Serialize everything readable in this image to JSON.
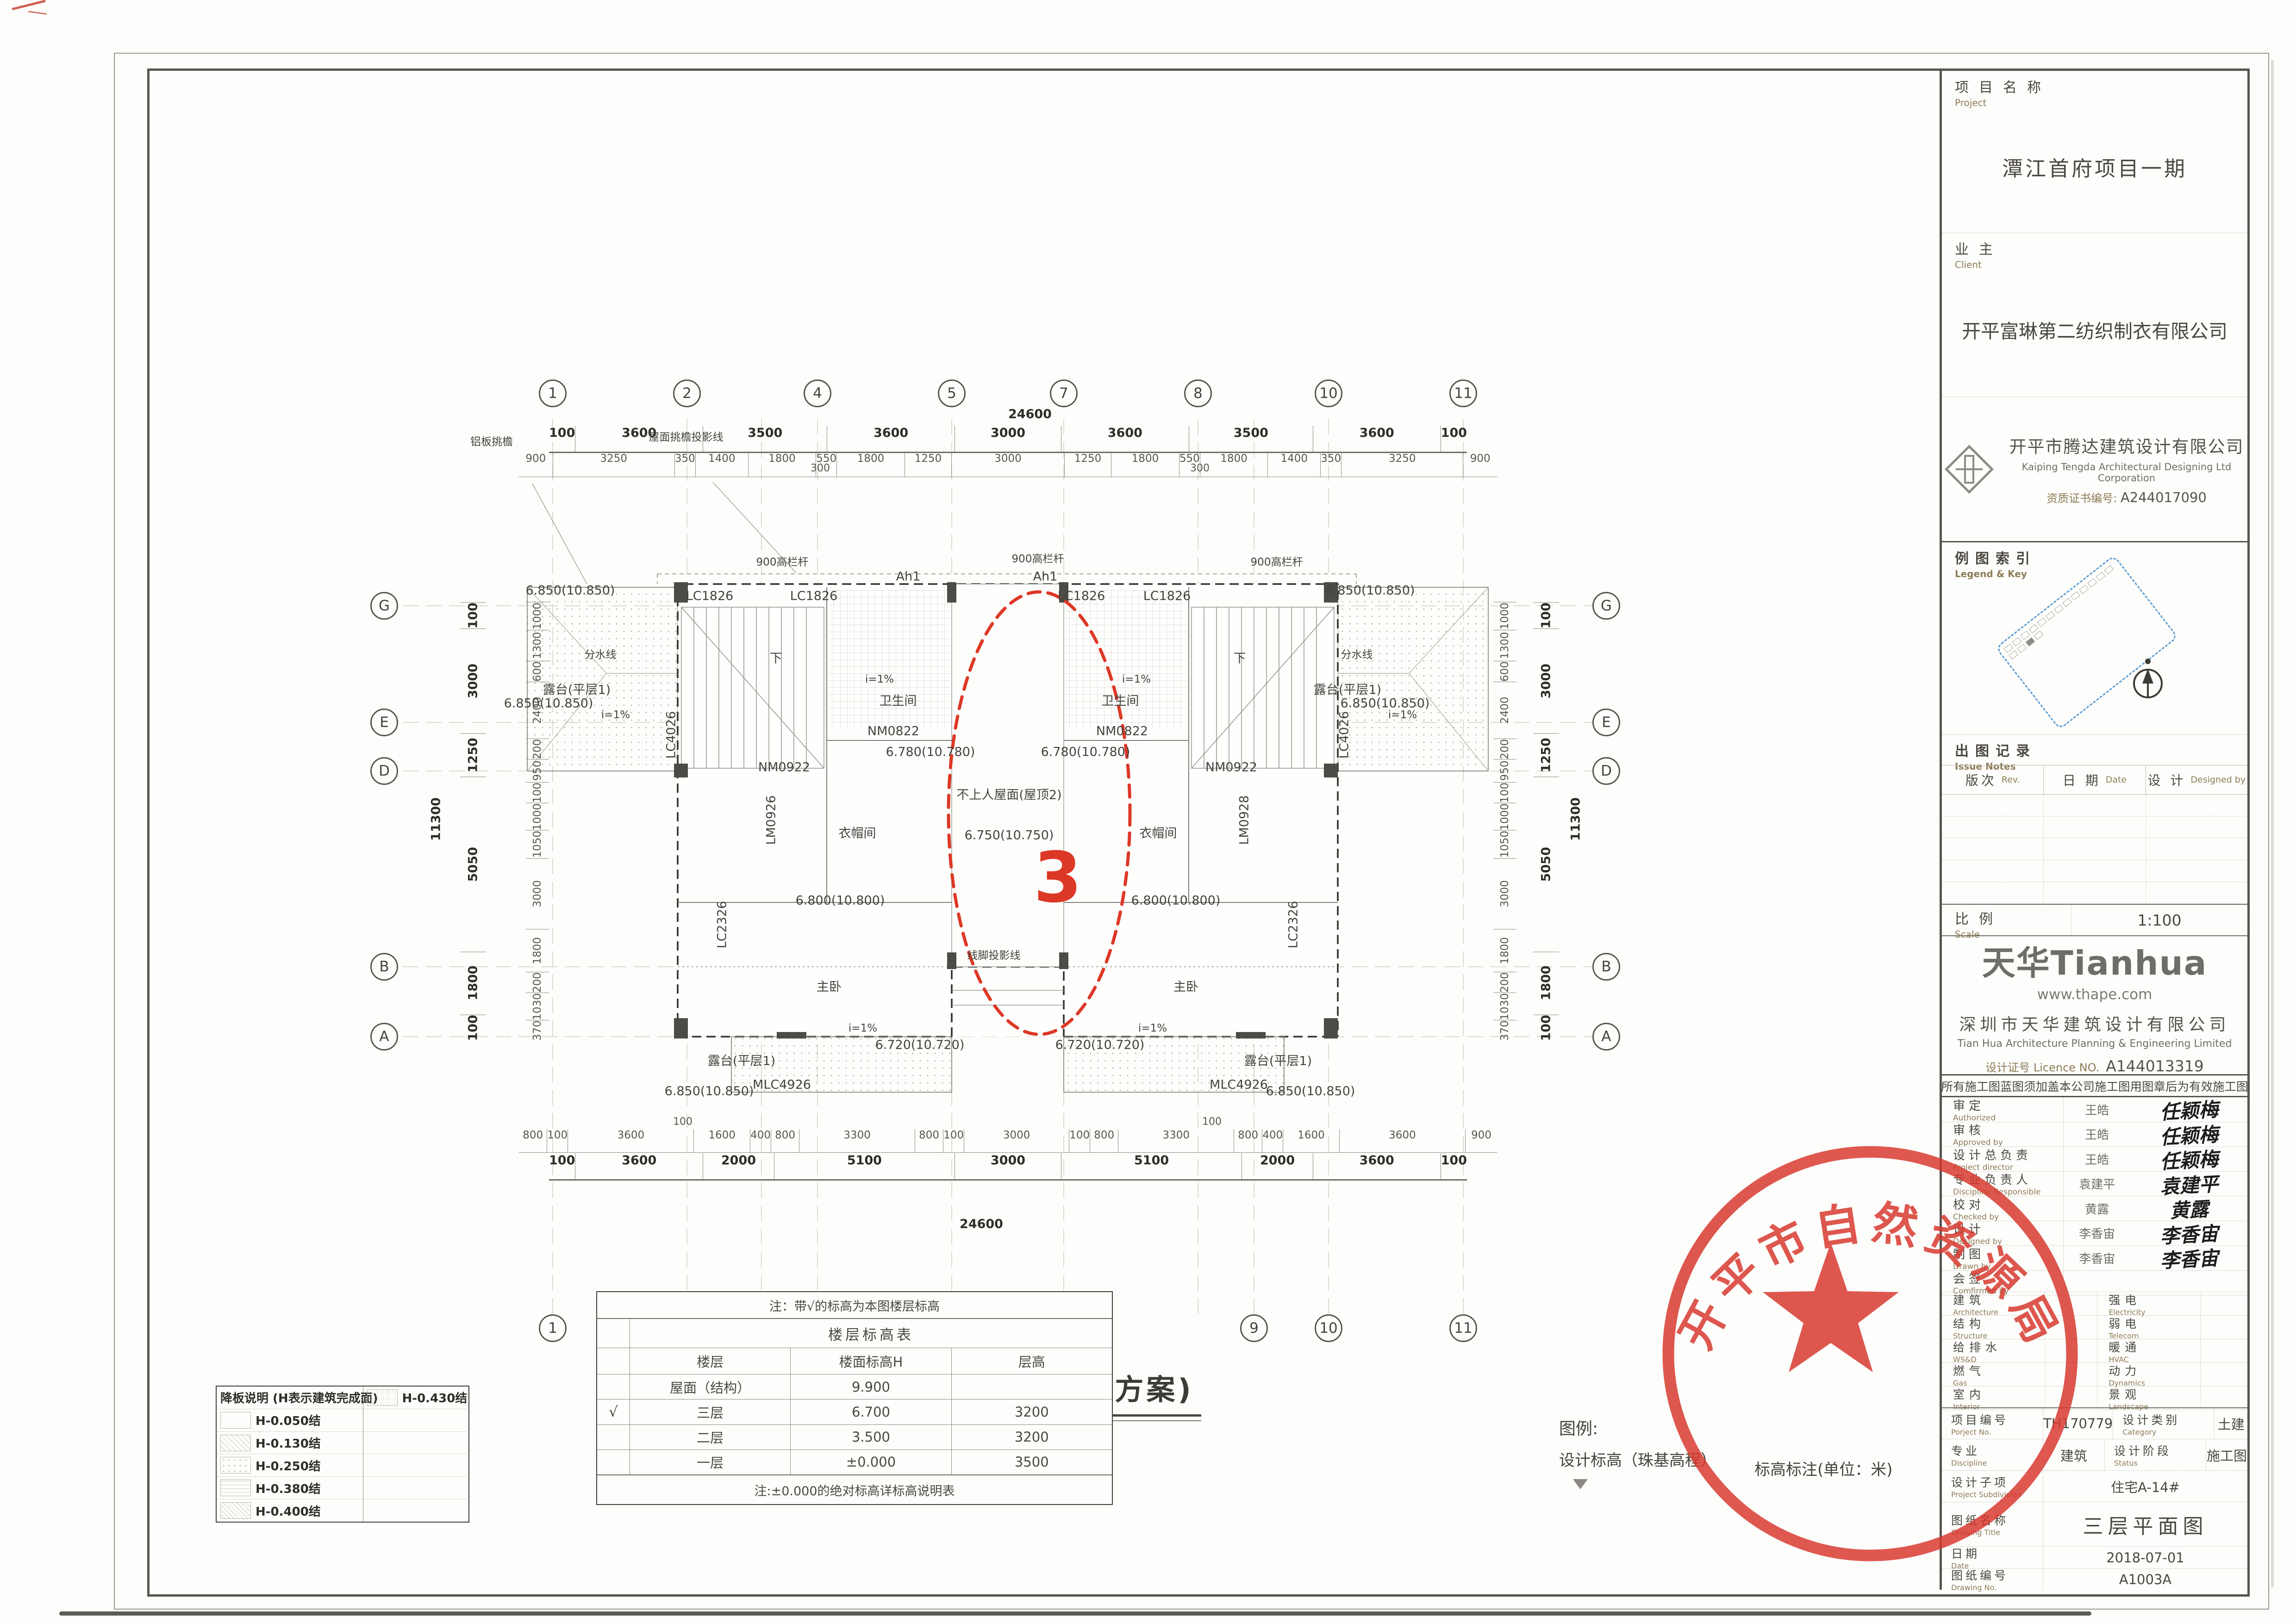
{
  "stamp": {
    "agency": "开平市自然资源局",
    "color": "#d8382e"
  },
  "caption": "三层平面图(原方案)",
  "legend": {
    "title": "图例:",
    "item_elevation": "设计标高（珠基高程）",
    "item_unit": "标高标注(单位：米)"
  },
  "plan": {
    "revision_number": "3",
    "grid": {
      "top_bubbles": [
        "1",
        "2",
        "4",
        "5",
        "7",
        "8",
        "10",
        "11"
      ],
      "bottom_bubbles": [
        "1",
        "2",
        "3",
        "5",
        "7",
        "9",
        "10",
        "11"
      ],
      "left_bubbles": [
        "G",
        "E",
        "D",
        "B",
        "A"
      ],
      "right_bubbles": [
        "G",
        "E",
        "D",
        "B",
        "A"
      ]
    },
    "dims": {
      "top_overall": "24600",
      "top_main": [
        "100",
        "3600",
        "3500",
        "3600",
        "3000",
        "3600",
        "3500",
        "3600",
        "100"
      ],
      "top_detail": [
        "900",
        "3250",
        "350",
        "1400",
        "1800",
        "550",
        "1800",
        "1250",
        "3000",
        "1250",
        "1800",
        "550",
        "1800",
        "1400",
        "350",
        "3250",
        "900"
      ],
      "offset300": "300",
      "bottom_detail": [
        "800",
        "100",
        "3600",
        "1600",
        "400",
        "800",
        "3300",
        "800",
        "100",
        "3000",
        "100",
        "800",
        "3300",
        "800",
        "400",
        "1600",
        "3600",
        "900"
      ],
      "offset100": "100",
      "bottom_main": [
        "100",
        "3600",
        "2000",
        "5100",
        "3000",
        "5100",
        "2000",
        "3600",
        "100"
      ],
      "bottom_overall": "24600",
      "left_detail": [
        "1000",
        "1300",
        "600",
        "2400",
        "200",
        "950",
        "100",
        "1000",
        "1050",
        "3000",
        "1800",
        "200",
        "1030",
        "370"
      ],
      "left_main": [
        "100",
        "3000",
        "1250",
        "5050",
        "1800",
        "100"
      ],
      "left_overall": "11300",
      "right_detail": [
        "1000",
        "1300",
        "600",
        "2400",
        "200",
        "950",
        "100",
        "1000",
        "1050",
        "3000",
        "1800",
        "200",
        "1030",
        "370"
      ],
      "right_main": [
        "100",
        "3000",
        "1250",
        "5050",
        "1800",
        "100"
      ],
      "right_overall": "11300"
    },
    "labels": {
      "alu_eave": "铝板挑檐",
      "eave_line": "屋面挑檐投影线",
      "rail": "900高栏杆",
      "ah1": "Ah1",
      "lc1826": "LC1826",
      "e6850": "6.850(10.850)",
      "watershed": "分水线",
      "terrace1": "露台(平层1)",
      "slope": "i=1%",
      "bath": "卫生间",
      "nm0822": "NM0822",
      "e6780": "6.780(10.780)",
      "down": "下",
      "nm0922": "NM0922",
      "lm0926": "LM0926",
      "lm0928": "LM0928",
      "cloak": "衣帽间",
      "lc4026": "LC4026",
      "center_roof": "不上人屋面(屋顶2)",
      "e6750": "6.750(10.750)",
      "e6800": "6.800(10.800)",
      "master": "主卧",
      "moulding": "线脚投影线",
      "lc2326": "LC2326",
      "mlc4926": "MLC4926",
      "e6720": "6.720(10.720)"
    }
  },
  "drop_slab_legend": {
    "title": "降板说明 (H表示建筑完成面)",
    "items": [
      {
        "label": "H-0.050结",
        "pattern": "plain-swatch-icon"
      },
      {
        "label": "H-0.130结",
        "pattern": "diagonal-hatch-icon"
      },
      {
        "label": "H-0.250结",
        "pattern": "dot-hatch-icon"
      },
      {
        "label": "H-0.380结",
        "pattern": "grid-hatch-icon"
      },
      {
        "label": "H-0.400结",
        "pattern": "cross-hatch-icon"
      },
      {
        "label": "H-0.430结",
        "pattern": "hex-hatch-icon"
      }
    ]
  },
  "floor_table": {
    "note_top": "注：带√的标高为本图楼层标高",
    "title": "楼层标高表",
    "headers": [
      "楼层",
      "楼面标高H",
      "层高"
    ],
    "rows": [
      {
        "check": "",
        "floor": "屋面（结构）",
        "elev": "9.900",
        "height": ""
      },
      {
        "check": "√",
        "floor": "三层",
        "elev": "6.700",
        "height": "3200"
      },
      {
        "check": "",
        "floor": "二层",
        "elev": "3.500",
        "height": "3200"
      },
      {
        "check": "",
        "floor": "一层",
        "elev": "±0.000",
        "height": "3500"
      }
    ],
    "note_bottom": "注:±0.000的绝对标高详标高说明表"
  },
  "titleblock": {
    "project_label": "项目名称",
    "project_label_en": "Project",
    "project_name": "潭江首府项目一期",
    "client_label": "业主",
    "client_label_en": "Client",
    "client_name": "开平富琳第二纺织制衣有限公司",
    "designer_cn": "开平市腾达建筑设计有限公司",
    "designer_en": "Kaiping Tengda Architectural Designing Ltd Corporation",
    "cert_label": "资质证书编号:",
    "cert_no": "A244017090",
    "legend_key_label": "例图索引",
    "legend_key_en": "Legend & Key",
    "issue_label": "出图记录",
    "issue_en": "Issue Notes",
    "issue_headers": [
      {
        "cn": "版次",
        "en": "Rev."
      },
      {
        "cn": "日 期",
        "en": "Date"
      },
      {
        "cn": "设 计",
        "en": "Designed by"
      }
    ],
    "scale_label": "比例",
    "scale_en": "Scale",
    "scale_value": "1:100",
    "thape": {
      "logo": "天华Tianhua",
      "url": "www.thape.com",
      "company_cn": "深圳市天华建筑设计有限公司",
      "company_en": "Tian Hua Architecture Planning & Engineering Limited",
      "licence_label": "设计证号 Licence NO.",
      "licence_no": "A144013319"
    },
    "note": "所有施工图蓝图须加盖本公司施工图用图章后为有效施工图",
    "signatures": [
      {
        "cn": "审定",
        "en": "Authorized",
        "name": "王皓",
        "sig": "任颖梅"
      },
      {
        "cn": "审核",
        "en": "Approved by",
        "name": "王皓",
        "sig": "任颖梅"
      },
      {
        "cn": "设计总负责",
        "en": "Project director",
        "name": "王皓",
        "sig": "任颖梅"
      },
      {
        "cn": "专业负责人",
        "en": "Discipline Responsible",
        "name": "袁建平",
        "sig": "袁建平"
      },
      {
        "cn": "校对",
        "en": "Checked by",
        "name": "黄露",
        "sig": "黄露"
      },
      {
        "cn": "设计",
        "en": "Designed by",
        "name": "李香宙",
        "sig": "李香宙"
      },
      {
        "cn": "制图",
        "en": "Drawn by",
        "name": "李香宙",
        "sig": "李香宙"
      },
      {
        "cn": "会签",
        "en": "Comfirmed by",
        "name": "",
        "sig": ""
      }
    ],
    "disciplines": [
      {
        "l_cn": "建筑",
        "l_en": "Architecture",
        "r_cn": "强电",
        "r_en": "Electricity"
      },
      {
        "l_cn": "结构",
        "l_en": "Structure",
        "r_cn": "弱电",
        "r_en": "Telecom"
      },
      {
        "l_cn": "给排水",
        "l_en": "WS&D",
        "r_cn": "暖通",
        "r_en": "HVAC"
      },
      {
        "l_cn": "燃气",
        "l_en": "Gas",
        "r_cn": "动力",
        "r_en": "Dynamics"
      },
      {
        "l_cn": "室内",
        "l_en": "Interior",
        "r_cn": "景观",
        "r_en": "Landscape"
      }
    ],
    "project_no_label": "项目编号",
    "project_no_en": "Porject No.",
    "project_no": "TH170779",
    "category_label": "设计类别",
    "category_en": "Category",
    "category": "土建",
    "discipline_label": "专业",
    "discipline_en": "Discipline",
    "discipline": "建筑",
    "status_label": "设计阶段",
    "status_en": "Status",
    "status": "施工图",
    "subdivision_label": "设计子项",
    "subdivision_en": "Project Subdivision",
    "subdivision": "住宅A-14#",
    "title_label": "图纸名称",
    "title_en": "Drawing Title",
    "title": "三层平面图",
    "date_label": "日期",
    "date_en": "Date",
    "date": "2018-07-01",
    "no_label": "图纸编号",
    "no_en": "Drawing No.",
    "no": "A1003A"
  }
}
